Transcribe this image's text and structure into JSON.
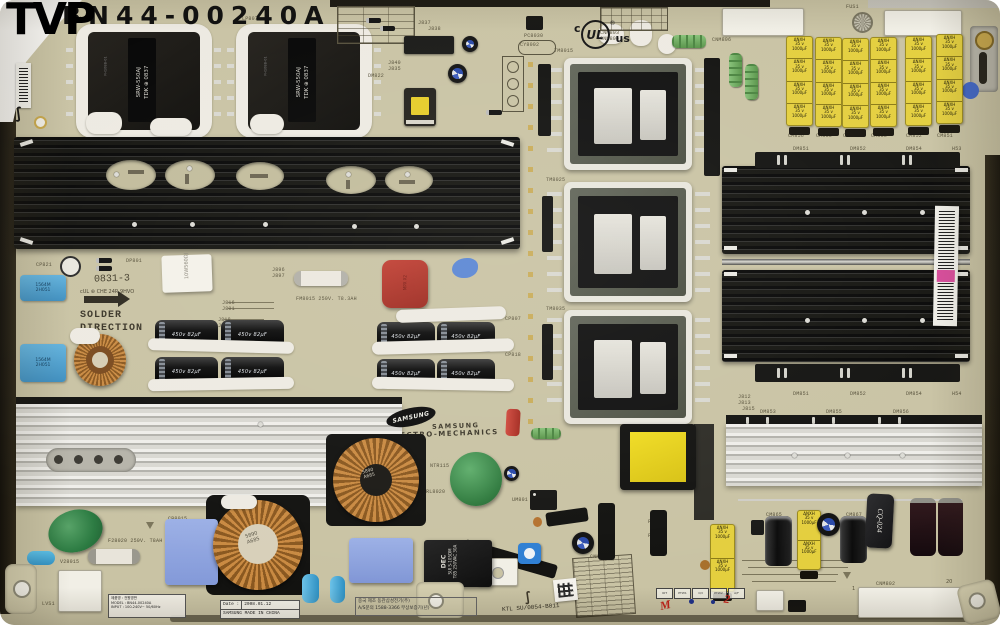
{
  "watermark": "TVP",
  "header": {
    "part_number": "BN44-00240A",
    "ul_c": "c",
    "ul_mark": "UL",
    "ul_reg": "®",
    "ul_us": "us"
  },
  "silkscreen": {
    "solder1": "SOLDER",
    "solder2": "DIRECTION",
    "stamp": "0831-3",
    "stamp_sub": "cUL ⊛ CHE 24R 9HVO",
    "brand_oval": "SAMSUNG",
    "brand_top": "SAMSUNG",
    "brand_bottom": "ELECTRO-MECHANICS",
    "labels": [
      {
        "t": "LP801",
        "x": 66,
        "y": 16
      },
      {
        "t": "LP807",
        "x": 242,
        "y": 16
      },
      {
        "t": "J837",
        "x": 418,
        "y": 20
      },
      {
        "t": "J838",
        "x": 428,
        "y": 26
      },
      {
        "t": "J840",
        "x": 388,
        "y": 60
      },
      {
        "t": "J835",
        "x": 388,
        "y": 66
      },
      {
        "t": "DM822",
        "x": 368,
        "y": 73
      },
      {
        "t": "PC8030",
        "x": 524,
        "y": 33
      },
      {
        "t": "CY8002",
        "x": 520,
        "y": 42
      },
      {
        "t": "TM8015",
        "x": 554,
        "y": 48
      },
      {
        "t": "TM8025",
        "x": 546,
        "y": 177
      },
      {
        "t": "TM8035",
        "x": 546,
        "y": 306
      },
      {
        "t": "CNM803",
        "x": 600,
        "y": 30
      },
      {
        "t": "CNM804",
        "x": 600,
        "y": 36
      },
      {
        "t": "FUS1",
        "x": 846,
        "y": 4
      },
      {
        "t": "CNM806",
        "x": 712,
        "y": 37
      },
      {
        "t": "CM856",
        "x": 788,
        "y": 133
      },
      {
        "t": "CM855",
        "x": 816,
        "y": 133
      },
      {
        "t": "CM854",
        "x": 843,
        "y": 133
      },
      {
        "t": "CM853",
        "x": 871,
        "y": 133
      },
      {
        "t": "CM852",
        "x": 906,
        "y": 133
      },
      {
        "t": "CM851",
        "x": 937,
        "y": 133
      },
      {
        "t": "J854",
        "x": 704,
        "y": 146
      },
      {
        "t": "DM851",
        "x": 793,
        "y": 146
      },
      {
        "t": "DM852",
        "x": 850,
        "y": 146
      },
      {
        "t": "DM854",
        "x": 906,
        "y": 146
      },
      {
        "t": "H53",
        "x": 952,
        "y": 146
      },
      {
        "t": "DM851",
        "x": 793,
        "y": 391
      },
      {
        "t": "DM852",
        "x": 850,
        "y": 391
      },
      {
        "t": "DM854",
        "x": 906,
        "y": 391
      },
      {
        "t": "H54",
        "x": 952,
        "y": 391
      },
      {
        "t": "J812",
        "x": 738,
        "y": 394
      },
      {
        "t": "J813",
        "x": 738,
        "y": 400
      },
      {
        "t": "J815",
        "x": 742,
        "y": 406
      },
      {
        "t": "DM853",
        "x": 760,
        "y": 409
      },
      {
        "t": "DM855",
        "x": 826,
        "y": 409
      },
      {
        "t": "DM856",
        "x": 893,
        "y": 409
      },
      {
        "t": "CP821",
        "x": 36,
        "y": 262
      },
      {
        "t": "DP801",
        "x": 126,
        "y": 258
      },
      {
        "t": "J896",
        "x": 272,
        "y": 267
      },
      {
        "t": "J897",
        "x": 272,
        "y": 273
      },
      {
        "t": "J816",
        "x": 222,
        "y": 300
      },
      {
        "t": "J801",
        "x": 222,
        "y": 306
      },
      {
        "t": "J818",
        "x": 218,
        "y": 317
      },
      {
        "t": "J809",
        "x": 218,
        "y": 323
      },
      {
        "t": "CP807",
        "x": 505,
        "y": 316
      },
      {
        "t": "CP818",
        "x": 505,
        "y": 352
      },
      {
        "t": "PM8015",
        "x": 360,
        "y": 418
      },
      {
        "t": "LX8025",
        "x": 360,
        "y": 437
      },
      {
        "t": "RL8020",
        "x": 426,
        "y": 489
      },
      {
        "t": "NTR115",
        "x": 430,
        "y": 463
      },
      {
        "t": "UM801",
        "x": 512,
        "y": 497
      },
      {
        "t": "V28015",
        "x": 60,
        "y": 559
      },
      {
        "t": "F28020 250V. T8AH",
        "x": 108,
        "y": 538
      },
      {
        "t": "FM8015 250V. T8.3AH",
        "x": 296,
        "y": 296
      },
      {
        "t": "LVS1",
        "x": 42,
        "y": 601
      },
      {
        "t": "CB8015",
        "x": 168,
        "y": 516
      },
      {
        "t": "CNM851",
        "x": 590,
        "y": 554
      },
      {
        "t": "CNM802",
        "x": 876,
        "y": 581
      },
      {
        "t": "CM865",
        "x": 766,
        "y": 512
      },
      {
        "t": "CM867",
        "x": 846,
        "y": 512
      },
      {
        "t": "PC8015",
        "x": 648,
        "y": 519
      },
      {
        "t": "PC8025",
        "x": 648,
        "y": 533
      }
    ]
  },
  "components": {
    "transformer_label": "SRW-550AJ\nTDK ⊕ 0837",
    "transformer_side": "FH108B-01",
    "yellow_cap": "ΔNXH\n35 v\n1000µF",
    "black_cap": "450v 82µF",
    "blue_cap": "1564M\n2H051",
    "ceramic_res": "10W560ΩJ",
    "toroid_mark": "5890\nA685",
    "relay_l1": "DEC",
    "relay_l2": "SUI S-105DM",
    "relay_l3": "T85 250VAC 30A",
    "cq": "CQ-024",
    "squiggle": "∫"
  },
  "stickers": {
    "date_label": "Date :",
    "date_value": "2008.01.12",
    "made_in": "SAMSUNG MADE IN CHINA",
    "kr1": "중국 제조 동관삼성전기(주)",
    "kr2": "A/S문의 1588-3366 무상보증기(년)",
    "ktl": "KTL SU/0054-B011",
    "spec_rows": [
      "제품명 : 전원명판",
      "MODEL : BN44-00240A",
      "INPUT : 100-240V~ 50/60Hz"
    ]
  },
  "bottom": {
    "cells": [
      "IOT",
      "PTW1",
      "O/I",
      "PTW2",
      "A/F"
    ],
    "mark_m": "M",
    "mark_2": "2",
    "pin1": "1",
    "pin20": "20"
  }
}
